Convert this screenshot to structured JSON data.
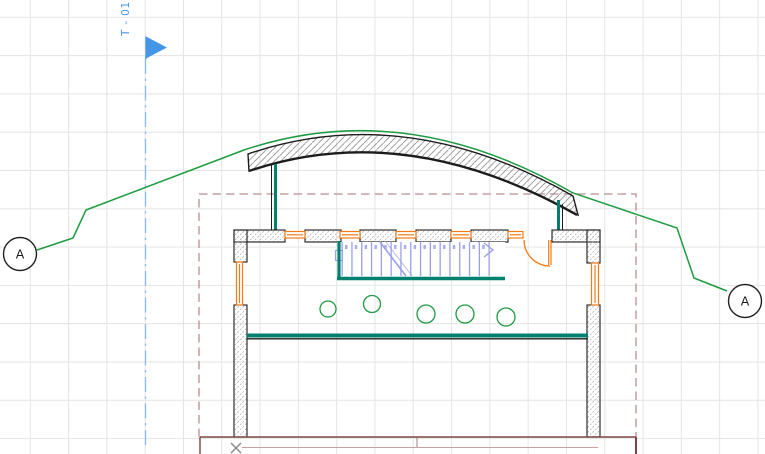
{
  "view": {
    "kind": "architectural plan with section marker and curved roof section",
    "grid_visible": true
  },
  "labels": {
    "section_flag": "T - 01",
    "elevation_left": "A",
    "elevation_right": "A"
  },
  "icons": {
    "section_flag": "flag-triangle-icon",
    "origin_marker": "x-marker-icon"
  },
  "colors": {
    "marker-blue": "#4596e6",
    "guide-blue": "#8ab9ec",
    "section-green": "#1f9c41",
    "wall-teal": "#00806e",
    "opening-orange": "#f57b17",
    "stair-blue": "#9b9fe8",
    "boundary-rose": "#b98f8f",
    "terrace-maroon": "#7a4545",
    "terrace-pink": "#cb9f9f",
    "drawing-black": "#1c1c1c",
    "hatch-gray": "#9a9a9a",
    "grid-gray": "#e4e4e4",
    "muted-gray": "#8a8a8a"
  }
}
